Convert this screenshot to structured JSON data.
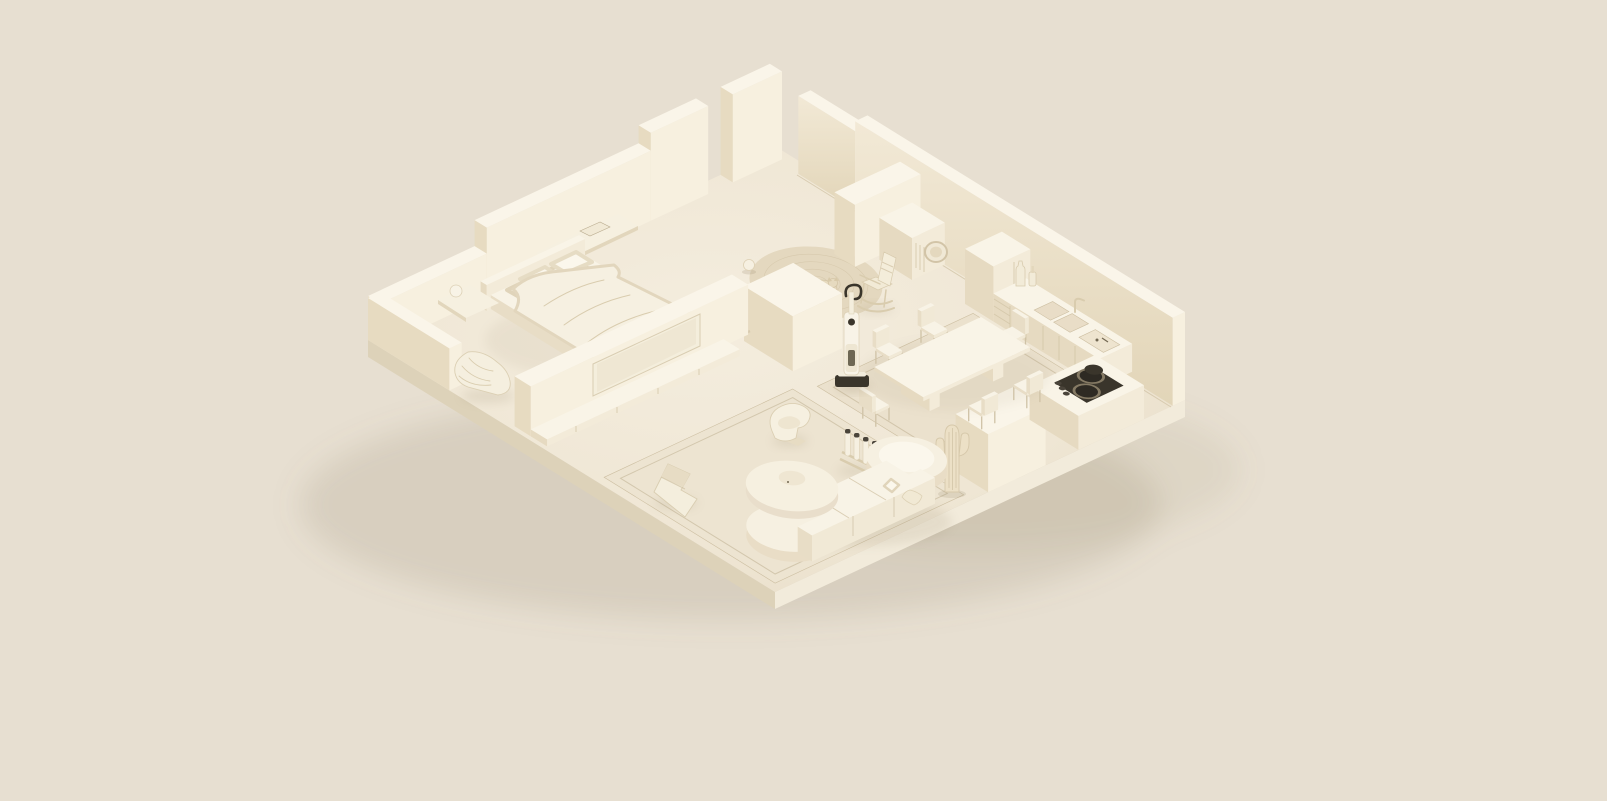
{
  "meta": {
    "title": "Monochrome cream 3D isometric cutaway render of a furnished apartment",
    "style": "single-color clay render, warm beige palette, no visible text"
  },
  "palette": {
    "bg": "#e7dfd1",
    "floorA": "#f3ecdc",
    "floorB": "#e9dfc9",
    "slabSW": "#ddd2b9",
    "slabSE": "#f2ebdb",
    "wallTop": "#faf5e9",
    "wallLit": "#f7f0df",
    "wallShadeA": "#f1e8d5",
    "wallShadeB": "#e2d5b8",
    "boxTop": "#f9f4e7",
    "boxSE": "#f3ebd9",
    "boxSW": "#e5d9c0",
    "legs": "#cfc2a6",
    "rugRound": "#e4d8bf",
    "rugDining": "#ebe1cd",
    "rugLiving": "#ede4d1",
    "rugLine": "#bdae90",
    "textile": "#f7f2e4",
    "textileShade": "#e0d4ba",
    "dark": "#3a352b",
    "softDark": "#726852",
    "shadow": "#8b7b5d"
  },
  "scene": {
    "type": "isometric-apartment",
    "background": "#e7dfd1",
    "rooms": [
      {
        "id": "bedroom",
        "label": "Bedroom",
        "items": [
          "double-bed",
          "four-pillows",
          "rumpled-duvet",
          "headboard",
          "wall-shelf",
          "book",
          "floating-nightstand",
          "sphere-lamp",
          "togo-lounge-chair",
          "tv-partition-wall",
          "wall-mounted-tv",
          "media-console",
          "low-exterior-wall"
        ]
      },
      {
        "id": "hallway",
        "label": "Hall / open area",
        "items": [
          "round-braided-rug",
          "cat",
          "cat-toy",
          "white-ball",
          "rocking-chair",
          "partition-block",
          "upright-wet-dry-vacuum",
          "washing-machine",
          "wall-stub",
          "doorway-gaps"
        ]
      },
      {
        "id": "dining-area",
        "label": "Dining area",
        "items": [
          "square-area-rug",
          "rectangular-dining-table",
          "six-dining-chairs"
        ]
      },
      {
        "id": "kitchen",
        "label": "Kitchen",
        "items": [
          "tall-cabinet",
          "counter-with-cabinet-doors",
          "drawer-unit",
          "double-sink",
          "faucet",
          "two-bottles",
          "cutting-board",
          "kitchen-island",
          "dark-cooktop-with-two-burners",
          "small-pot",
          "knobs"
        ]
      },
      {
        "id": "living-room",
        "label": "Living room",
        "items": [
          "large-area-rug",
          "curved-modular-sofa",
          "round-sofa-module",
          "throw-pillow",
          "round-coffee-table",
          "curved-lounge-chair",
          "zigzag-sculptural-chair",
          "bottle-stand-with-four-bottles",
          "tall-cactus",
          "vase-with-dry-branches",
          "small-white-vase"
        ]
      }
    ]
  }
}
